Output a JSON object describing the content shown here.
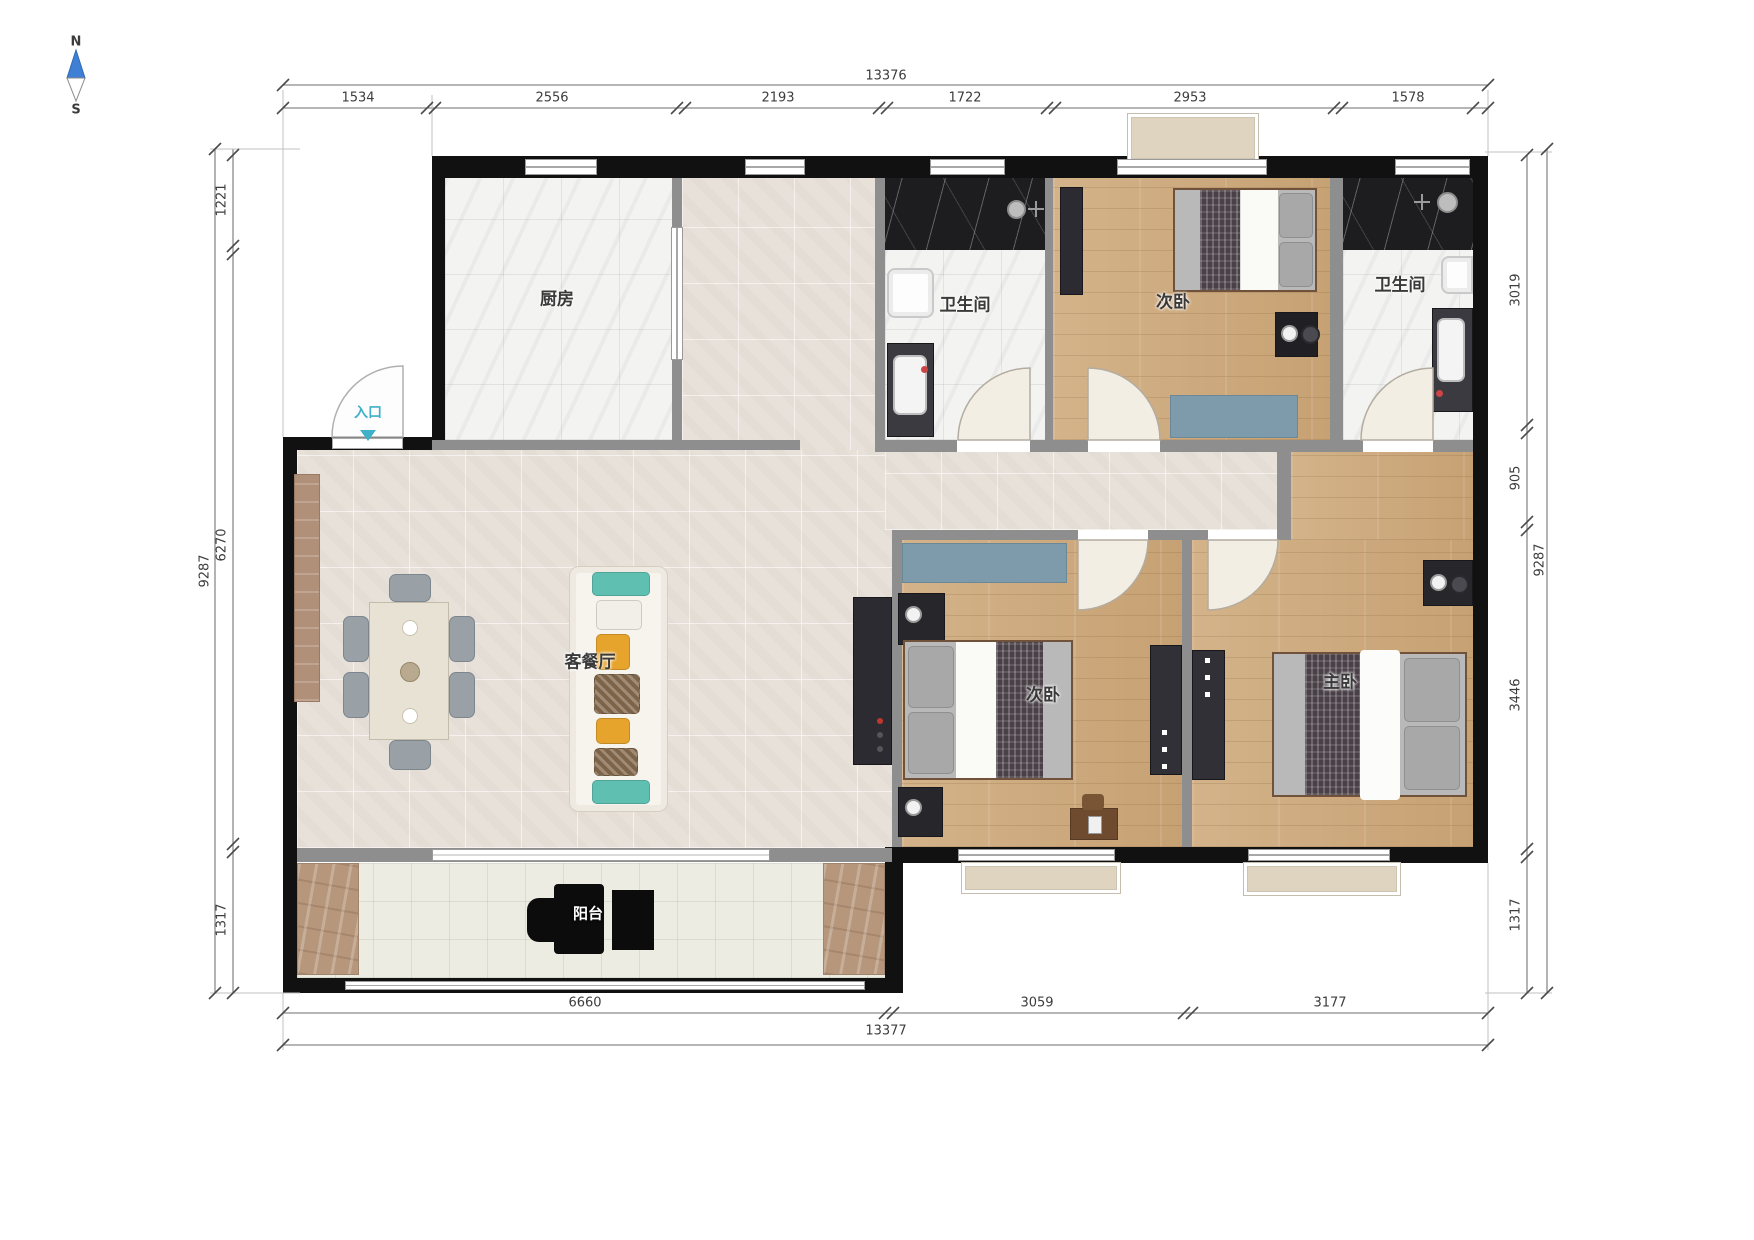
{
  "compass": {
    "north": "N",
    "south": "S"
  },
  "rooms": {
    "kitchen": "厨房",
    "bath_top": "卫生间",
    "bedroom_top": "次卧",
    "bath_right": "卫生间",
    "living": "客餐厅",
    "bedroom_mid": "次卧",
    "master": "主卧",
    "balcony": "阳台",
    "entrance": "入口"
  },
  "dims": {
    "top": {
      "total": "13376",
      "segments": [
        "1534",
        "2556",
        "2193",
        "1722",
        "2953",
        "1578"
      ]
    },
    "bottom": {
      "total": "13377",
      "segments": [
        "6660",
        "3059",
        "3177"
      ]
    },
    "left": {
      "total": "9287",
      "segments": [
        "1221",
        "6270",
        "1317"
      ]
    },
    "right": {
      "total": "9287",
      "segments": [
        "3019",
        "905",
        "3446",
        "1317"
      ]
    }
  },
  "colors": {
    "wall_black": "#111111",
    "wall_gray": "#8e8e8e",
    "wood_floor": "#cfae84",
    "tile_floor": "#e7e1d9",
    "marble_light": "#f3f3f1",
    "marble_dark": "#1d1d1f",
    "accent_blue": "#7e9bac",
    "entry_teal": "#3fb0c9",
    "window_box_beige": "#ded4bf"
  }
}
